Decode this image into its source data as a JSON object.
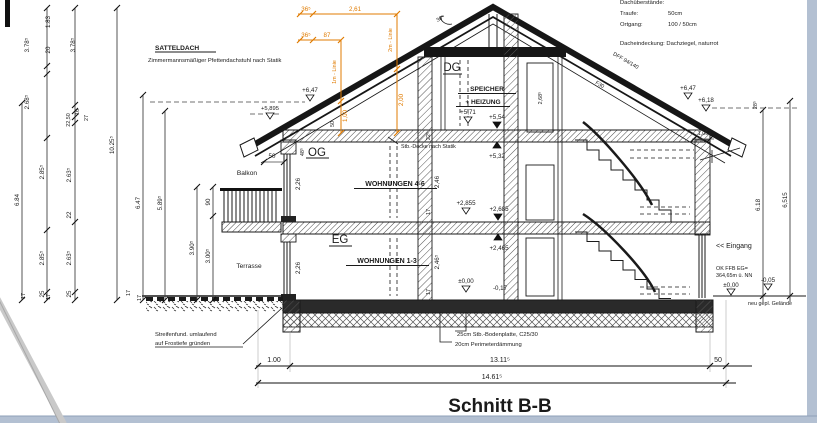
{
  "page": {
    "title": "Schnitt B-B"
  },
  "colors": {
    "ink": "#1a1a1a",
    "construction_orange": "#e07b00",
    "page_edge_blue": "#b3c0d2"
  },
  "notes": {
    "dach_header": "Dachüberstände:",
    "traufe_label": "Traufe:",
    "traufe_value": "50cm",
    "ortgang_label": "Ortgang:",
    "ortgang_value": "100 / 50cm",
    "eindeckung": "Dacheindeckung: Dachziegel, naturrot",
    "satteldach": "SATTELDACH",
    "satteldach_sub": "Zimmermannsmäßiger Pfettendachstuhl nach Statik",
    "rafter": "DFF 94/140",
    "f30": "F30",
    "pitch": "30°",
    "decke": "Stb.-Decke nach Statik",
    "found1": "Streifenfund. umlaufend",
    "found2": "auf Frostiefe gründen",
    "bodenplatte": "25cm Stb.-Bodenplatte, C25/30",
    "perimeter": "20cm Perimeterdämmung",
    "eingang": "<< Eingang",
    "ok_ffb1": "OK FFB EG=",
    "ok_ffb2": "364,65m ü. NN",
    "gelaende": "neu gepl. Gelände"
  },
  "rooms": {
    "dg": "DG",
    "speicher": "SPEICHER",
    "heizung": "+ HEIZUNG",
    "og": "OG",
    "w46": "WOHNUNGEN 4-6",
    "eg": "EG",
    "w13": "WOHNUNGEN 1-3",
    "balkon": "Balkon",
    "terrasse": "Terrasse"
  },
  "levels": [
    "+6,47",
    "+5,895",
    "+6,47",
    "+6,18",
    "+5,71",
    "+5,54",
    "+5,32",
    "+2,855",
    "+2,685",
    "+2,465",
    "±0,00",
    "-0,17",
    "±0,00",
    "-0,05"
  ],
  "dims": {
    "left": [
      "3.78⁵",
      "2.68⁵",
      "1.83",
      "20",
      "3.78⁵",
      "27",
      "16",
      "22,50",
      "2.85⁵",
      "2.85⁵",
      "25",
      "2.63⁵",
      "22",
      "2.63⁵",
      "25",
      "6.84",
      "10.25⁵",
      "6.47",
      "5.89⁵",
      "3.90⁵",
      "3.00⁵",
      "90",
      "17",
      "17",
      "17",
      "17"
    ],
    "right": [
      "28⁵",
      "6.18",
      "6,515",
      "1,00"
    ],
    "bottom": [
      "1.00",
      "13.11⁵",
      "14.61⁵",
      "50"
    ],
    "orange": [
      "36⁵",
      "2,61",
      "36⁵",
      "87",
      "2m - Linie",
      "2,00",
      "1m - Linie",
      "1,00"
    ],
    "inner": [
      "50",
      "48⁵",
      "2,26",
      "2,26",
      "2,46",
      "2,46⁵",
      "17",
      "17",
      "22⁵",
      "50",
      "2,68⁵"
    ]
  }
}
